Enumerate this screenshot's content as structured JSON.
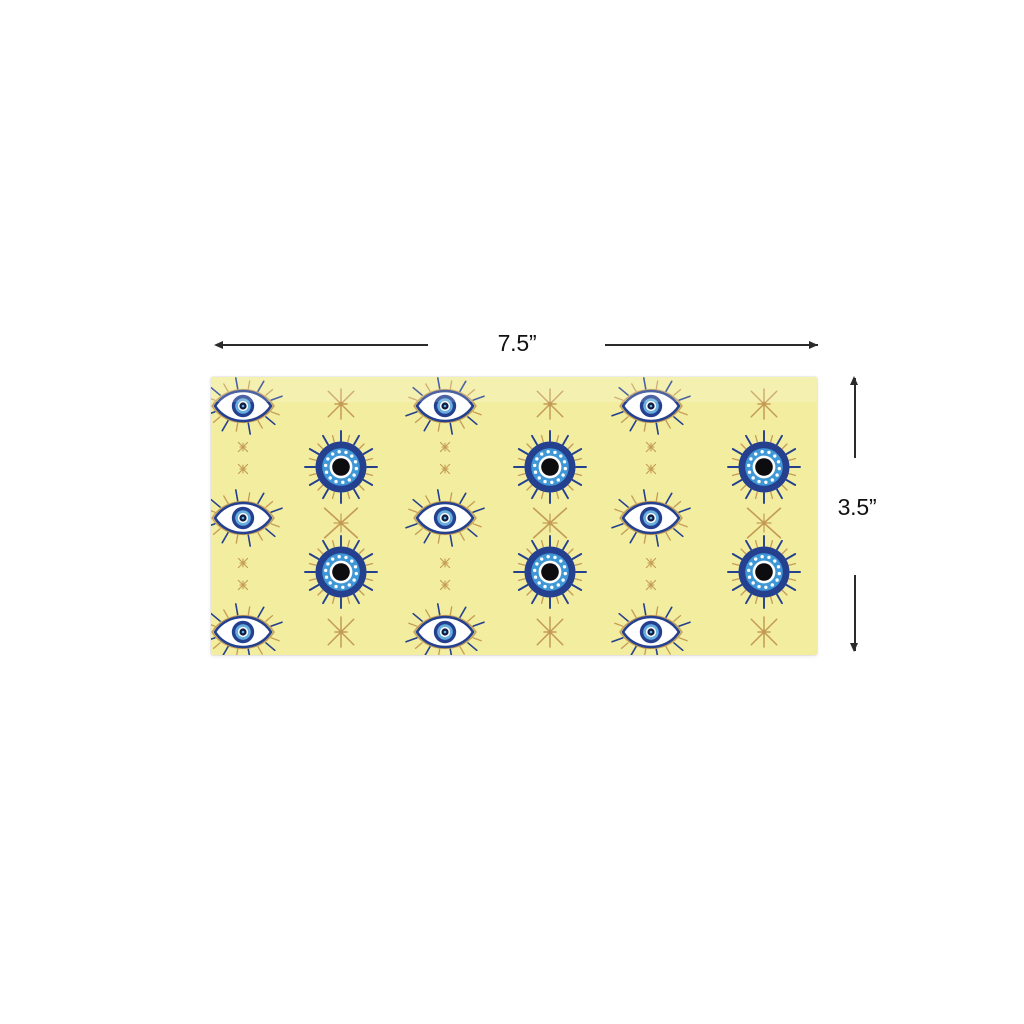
{
  "dimensions": {
    "width_label": "7.5”",
    "height_label": "3.5”"
  },
  "colors": {
    "page_bg": "#ffffff",
    "dimension_line": "#2b2b2b",
    "label_text": "#111111",
    "paper_yellow": "#f2ed9f",
    "paper_highlight": "rgba(255,255,255,0.18)",
    "navy": "#24408f",
    "azure": "#3f97d6",
    "sky": "#66aee0",
    "gold": "#c49b55",
    "white": "#ffffff",
    "pupil_dark": "#101c42",
    "pupil_black": "#0d0d10"
  },
  "pattern": {
    "rect": {
      "x": 211,
      "y": 377,
      "w": 606,
      "h": 278
    },
    "almond_eyes": [
      [
        32,
        29
      ],
      [
        234,
        29
      ],
      [
        440,
        29
      ],
      [
        32,
        141
      ],
      [
        234,
        141
      ],
      [
        440,
        141
      ],
      [
        32,
        255
      ],
      [
        234,
        255
      ],
      [
        440,
        255
      ]
    ],
    "circular_eyes": [
      [
        130,
        90
      ],
      [
        339,
        90
      ],
      [
        553,
        90
      ],
      [
        130,
        195
      ],
      [
        339,
        195
      ],
      [
        553,
        195
      ]
    ],
    "sparkles_large": [
      [
        130,
        27
      ],
      [
        339,
        27
      ],
      [
        553,
        27
      ],
      [
        130,
        255
      ],
      [
        339,
        255
      ],
      [
        553,
        255
      ]
    ],
    "x_stars": [
      [
        130,
        146
      ],
      [
        339,
        146
      ],
      [
        553,
        146
      ]
    ],
    "sparkles_small": [
      [
        32,
        70
      ],
      [
        32,
        92
      ],
      [
        234,
        70
      ],
      [
        234,
        92
      ],
      [
        440,
        70
      ],
      [
        440,
        92
      ],
      [
        32,
        186
      ],
      [
        32,
        208
      ],
      [
        234,
        186
      ],
      [
        234,
        208
      ],
      [
        440,
        186
      ],
      [
        440,
        208
      ]
    ]
  }
}
